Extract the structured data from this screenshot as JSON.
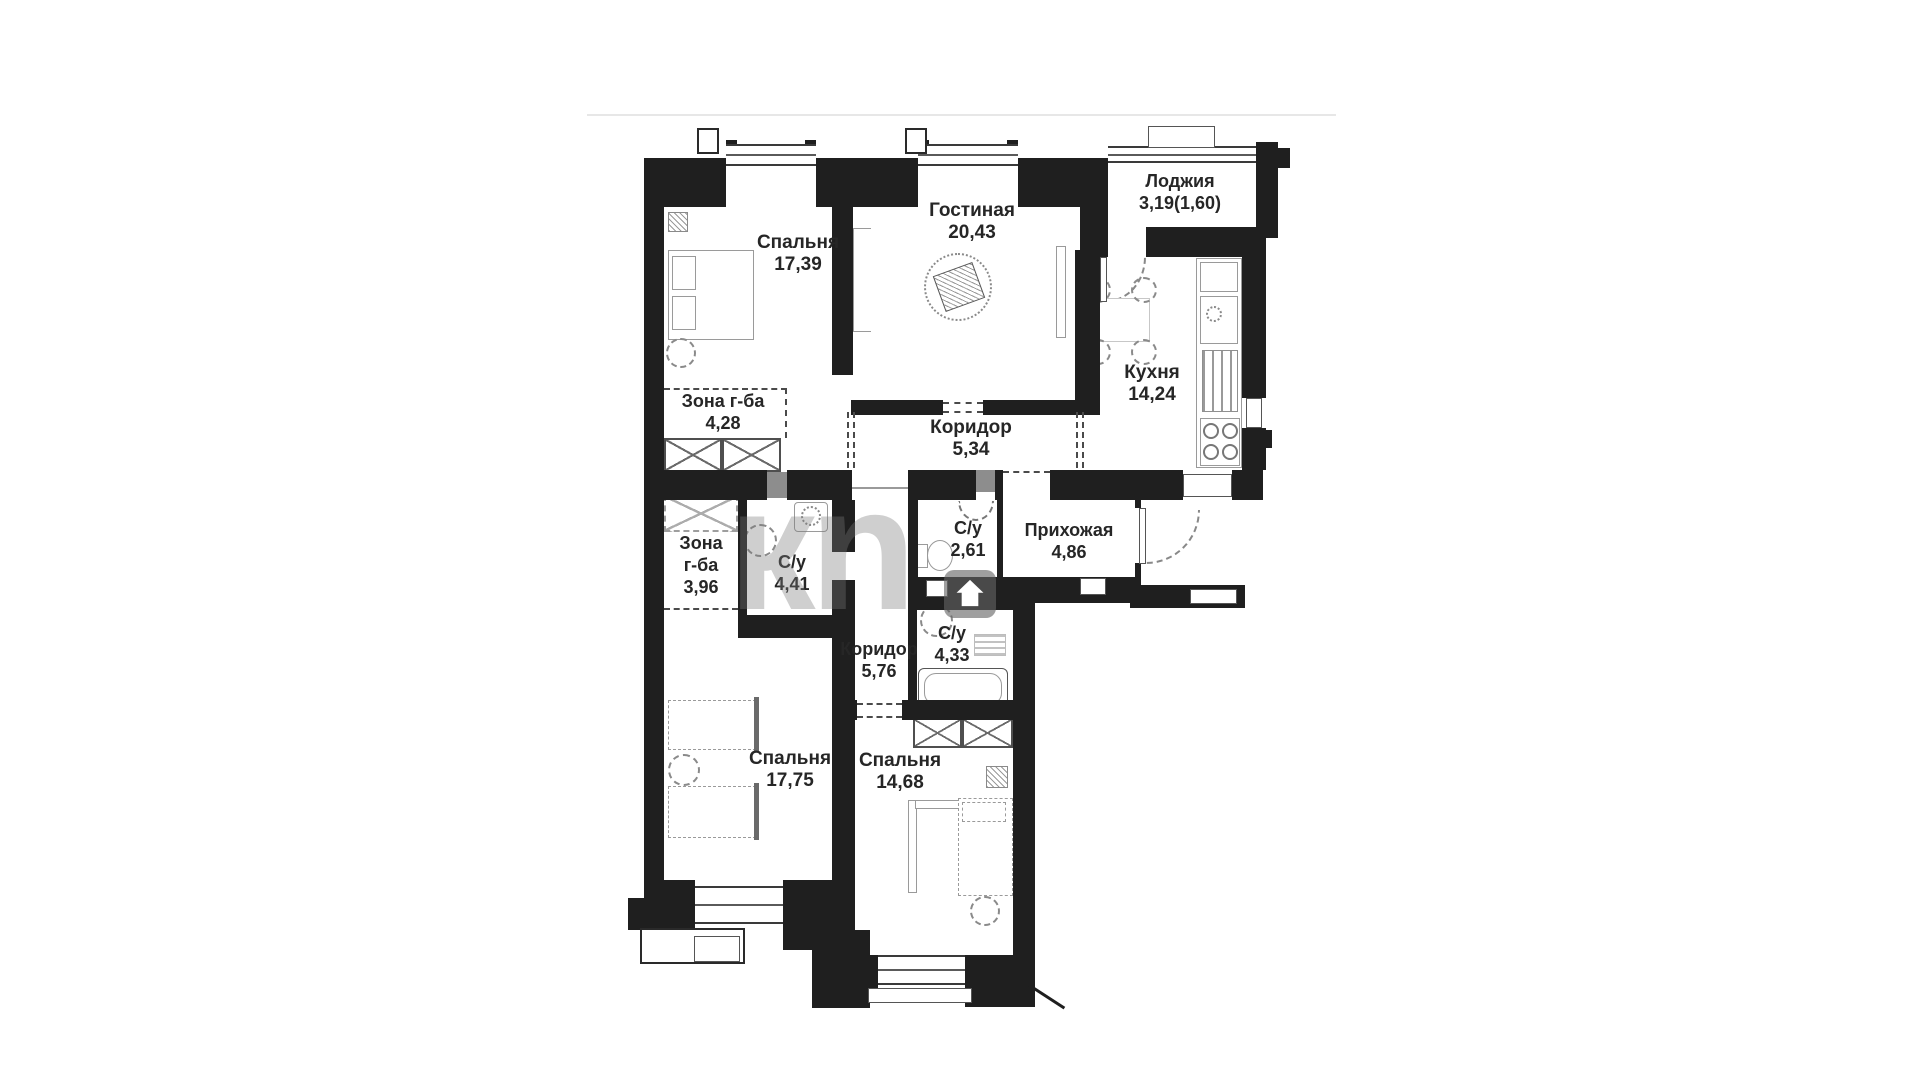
{
  "watermark": {
    "text": "кn"
  },
  "rooms": {
    "bedroom1": {
      "name": "Спальня",
      "area": "17,39"
    },
    "living": {
      "name": "Гостиная",
      "area": "20,43"
    },
    "loggia": {
      "name": "Лоджия",
      "area": "3,19(1,60)"
    },
    "kitchen": {
      "name": "Кухня",
      "area": "14,24"
    },
    "wardrobe1": {
      "name": "Зона г-ба",
      "area": "4,28"
    },
    "corridor1": {
      "name": "Коридор",
      "area": "5,34"
    },
    "wc1": {
      "name": "С/у",
      "area": "2,61"
    },
    "hallway": {
      "name": "Прихожая",
      "area": "4,86"
    },
    "wardrobe2": {
      "name_line1": "Зона",
      "name_line2": "г-ба",
      "area": "3,96"
    },
    "bathroom1": {
      "name": "С/у",
      "area": "4,41"
    },
    "corridor2": {
      "name": "Коридор",
      "area": "5,76"
    },
    "bathroom2": {
      "name": "С/у",
      "area": "4,33"
    },
    "bedroom2": {
      "name": "Спальня",
      "area": "17,75"
    },
    "bedroom3": {
      "name": "Спальня",
      "area": "14,68"
    }
  }
}
